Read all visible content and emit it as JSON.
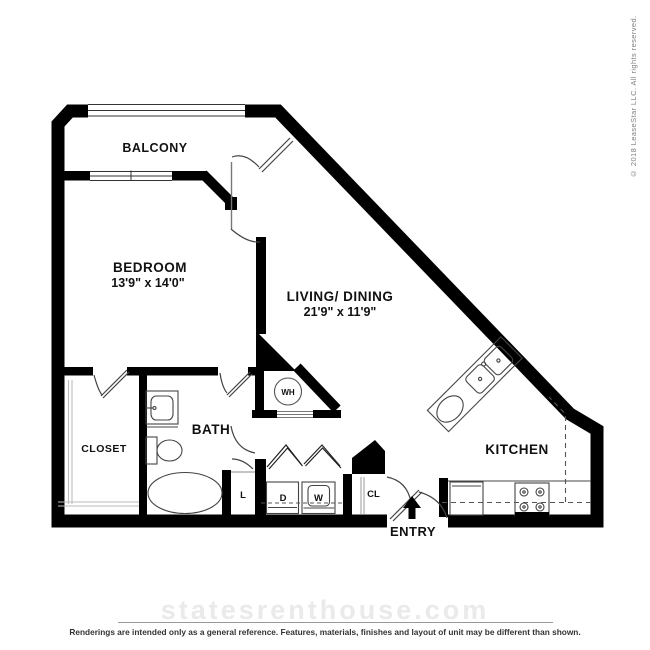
{
  "floor_plan": {
    "rooms": {
      "balcony": {
        "label": "BALCONY"
      },
      "bedroom": {
        "label": "BEDROOM",
        "dimensions": "13'9\" x 14'0\""
      },
      "living_dining": {
        "label": "LIVING/ DINING",
        "dimensions": "21'9\" x 11'9\""
      },
      "kitchen": {
        "label": "KITCHEN"
      },
      "bath": {
        "label": "BATH"
      },
      "closet": {
        "label": "CLOSET"
      },
      "entry": {
        "label": "ENTRY"
      }
    },
    "features": {
      "water_heater": {
        "abbr": "WH"
      },
      "linen_closet": {
        "abbr": "L"
      },
      "dryer": {
        "abbr": "D"
      },
      "washer": {
        "abbr": "W"
      },
      "coat_closet": {
        "abbr": "CL"
      }
    }
  },
  "footer": {
    "watermark": "statesrenthouse.com",
    "disclaimer": "Renderings are intended only as a general reference. Features, materials, finishes and layout of unit may be different than shown."
  },
  "copyright": {
    "text": "© 2018 LeaseStar LLC. All rights reserved."
  },
  "colors": {
    "wall": "#000000",
    "fixture_line": "#444444",
    "shelf_line": "#bbbbbb",
    "watermark": "#eaeaea",
    "footer_text": "#333333",
    "copyright_text": "#808080",
    "background": "#ffffff"
  }
}
